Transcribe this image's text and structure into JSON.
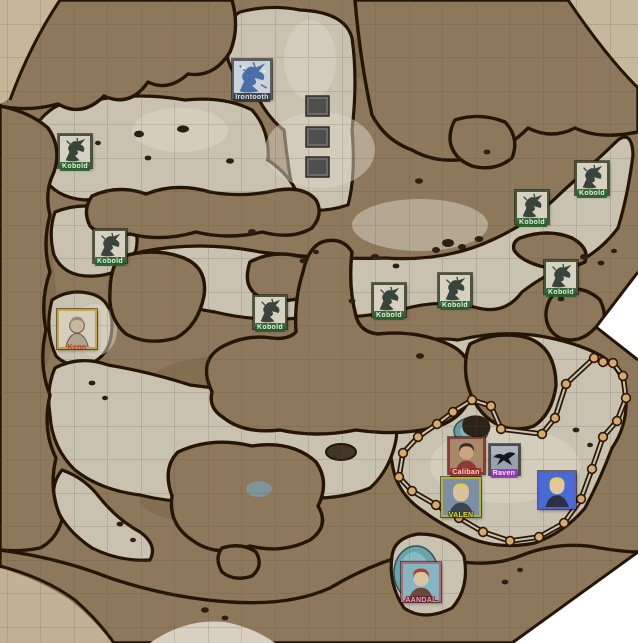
{
  "map": {
    "name": "canyon-kobold-lair-battle-map",
    "grid_size": 33.5,
    "colors": {
      "floor": "#c9c2b1",
      "dirt": "#8d785b",
      "outline": "#241505",
      "grid": "#5a5242",
      "paper_margin": "#c6b697",
      "water": "#639ca4",
      "pit": "#6b6b69",
      "fence_line": "#2a1808",
      "fence_node_fill": "#d8a96e"
    }
  },
  "drawing": {
    "name": "barrier-path",
    "closed": true,
    "points": [
      [
        472,
        400
      ],
      [
        491,
        406
      ],
      [
        501,
        429
      ],
      [
        542,
        434
      ],
      [
        555,
        418
      ],
      [
        566,
        384
      ],
      [
        594,
        358
      ],
      [
        603,
        362
      ],
      [
        613,
        363
      ],
      [
        623,
        376
      ],
      [
        626,
        398
      ],
      [
        617,
        421
      ],
      [
        603,
        437
      ],
      [
        592,
        469
      ],
      [
        581,
        499
      ],
      [
        564,
        523
      ],
      [
        539,
        537
      ],
      [
        510,
        541
      ],
      [
        483,
        532
      ],
      [
        459,
        518
      ],
      [
        436,
        505
      ],
      [
        412,
        491
      ],
      [
        399,
        477
      ],
      [
        403,
        453
      ],
      [
        418,
        437
      ],
      [
        437,
        424
      ],
      [
        453,
        412
      ]
    ]
  },
  "tokens": [
    {
      "id": "irontooth",
      "label": "Irontooth",
      "x": 252,
      "y": 79,
      "size": 40,
      "art": "drake",
      "colors": {
        "bg": "#ccd2d8",
        "fg": "#4a6ea6",
        "border": "#565e68"
      },
      "label_style": {
        "bg": "rgba(52,56,62,0.92)",
        "color": "#dde3ea"
      }
    },
    {
      "id": "kobold-1",
      "label": "Kobold",
      "x": 75,
      "y": 151,
      "size": 34,
      "art": "kobold",
      "colors": {
        "bg": "#d6d1c0",
        "fg": "#39453c",
        "border": "#49563f"
      },
      "label_style": {
        "bg": "rgba(38,96,46,0.92)",
        "color": "#e6efdb"
      }
    },
    {
      "id": "kobold-2",
      "label": "Kobold",
      "x": 110,
      "y": 246,
      "size": 34,
      "art": "kobold",
      "colors": {
        "bg": "#d6d1c0",
        "fg": "#39453c",
        "border": "#49563f"
      },
      "label_style": {
        "bg": "rgba(38,96,46,0.92)",
        "color": "#e6efdb"
      }
    },
    {
      "id": "kobold-3",
      "label": "Kobold",
      "x": 270,
      "y": 312,
      "size": 34,
      "art": "kobold",
      "colors": {
        "bg": "#d6d1c0",
        "fg": "#39453c",
        "border": "#49563f"
      },
      "label_style": {
        "bg": "rgba(38,96,46,0.92)",
        "color": "#e6efdb"
      }
    },
    {
      "id": "kobold-4",
      "label": "Kobold",
      "x": 389,
      "y": 300,
      "size": 34,
      "art": "kobold",
      "colors": {
        "bg": "#d6d1c0",
        "fg": "#39453c",
        "border": "#49563f"
      },
      "label_style": {
        "bg": "rgba(38,96,46,0.92)",
        "color": "#e6efdb"
      }
    },
    {
      "id": "kobold-5",
      "label": "Kobold",
      "x": 455,
      "y": 290,
      "size": 34,
      "art": "kobold",
      "colors": {
        "bg": "#d6d1c0",
        "fg": "#39453c",
        "border": "#49563f"
      },
      "label_style": {
        "bg": "rgba(38,96,46,0.92)",
        "color": "#e6efdb"
      }
    },
    {
      "id": "kobold-6",
      "label": "Kobold",
      "x": 532,
      "y": 207,
      "size": 34,
      "art": "kobold",
      "colors": {
        "bg": "#d6d1c0",
        "fg": "#39453c",
        "border": "#49563f"
      },
      "label_style": {
        "bg": "rgba(38,96,46,0.92)",
        "color": "#e6efdb"
      }
    },
    {
      "id": "kobold-7",
      "label": "Kobold",
      "x": 561,
      "y": 277,
      "size": 34,
      "art": "kobold",
      "colors": {
        "bg": "#d6d1c0",
        "fg": "#39453c",
        "border": "#49563f"
      },
      "label_style": {
        "bg": "rgba(38,96,46,0.92)",
        "color": "#e6efdb"
      }
    },
    {
      "id": "kobold-8",
      "label": "Kobold",
      "x": 592,
      "y": 178,
      "size": 34,
      "art": "kobold",
      "colors": {
        "bg": "#d6d1c0",
        "fg": "#39453c",
        "border": "#49563f"
      },
      "label_style": {
        "bg": "rgba(38,96,46,0.92)",
        "color": "#e6efdb"
      }
    },
    {
      "id": "kenn",
      "label": "Kenn",
      "x": 77,
      "y": 329,
      "size": 40,
      "art": "sketch",
      "colors": {
        "bg": "#d5cfbf",
        "skin": "#c9b79b",
        "hair": "#9a8a6e",
        "top": "#b0a58c",
        "border": "#c9a43b"
      },
      "label_style": {
        "bg": "transparent",
        "color": "#c03a2e"
      }
    },
    {
      "id": "caliban",
      "label": "Caliban",
      "x": 466,
      "y": 455,
      "size": 37,
      "art": "bust",
      "colors": {
        "bg": "#a78868",
        "skin": "#caa57f",
        "hair": "#3a2a22",
        "top": "#8a3a38",
        "border": "#8a3a38"
      },
      "label_style": {
        "bg": "rgba(150,44,40,0.85)",
        "color": "#ffd7c9"
      }
    },
    {
      "id": "raven",
      "label": "Raven",
      "x": 504,
      "y": 459,
      "size": 31,
      "art": "bird",
      "colors": {
        "bg": "#98a2ac",
        "fg": "#16161c",
        "border": "#4a4a52"
      },
      "label_style": {
        "bg": "rgba(148,52,182,0.9)",
        "color": "#f4e8fa"
      }
    },
    {
      "id": "valen",
      "label": "VALEN",
      "x": 461,
      "y": 497,
      "size": 40,
      "art": "bust",
      "colors": {
        "bg": "#7c8fa6",
        "skin": "#d9c29e",
        "hair": "#e3c96a",
        "top": "#3c4250",
        "border": "#aab43c"
      },
      "label_style": {
        "bg": "transparent",
        "color": "#e6cf3e",
        "shadow": "#2c4a1e"
      }
    },
    {
      "id": "blue-pc",
      "label": "",
      "x": 557,
      "y": 490,
      "size": 38,
      "art": "bust",
      "colors": {
        "bg": "#4a6bd4",
        "skin": "#e2c79e",
        "hair": "#e8d060",
        "top": "#2c3040",
        "border": "#5560d0"
      },
      "label_style": {
        "bg": "transparent",
        "color": "#ffffff"
      }
    },
    {
      "id": "aandal",
      "label": "AANDAL",
      "x": 421,
      "y": 582,
      "size": 40,
      "art": "bust",
      "colors": {
        "bg": "#86b4c0",
        "skin": "#d8c3a8",
        "hair": "#aa4428",
        "top": "#6a4838",
        "border": "#b06a78"
      },
      "label_style": {
        "bg": "transparent",
        "color": "#f2a4b4",
        "shadow": "#5a2430"
      }
    }
  ]
}
